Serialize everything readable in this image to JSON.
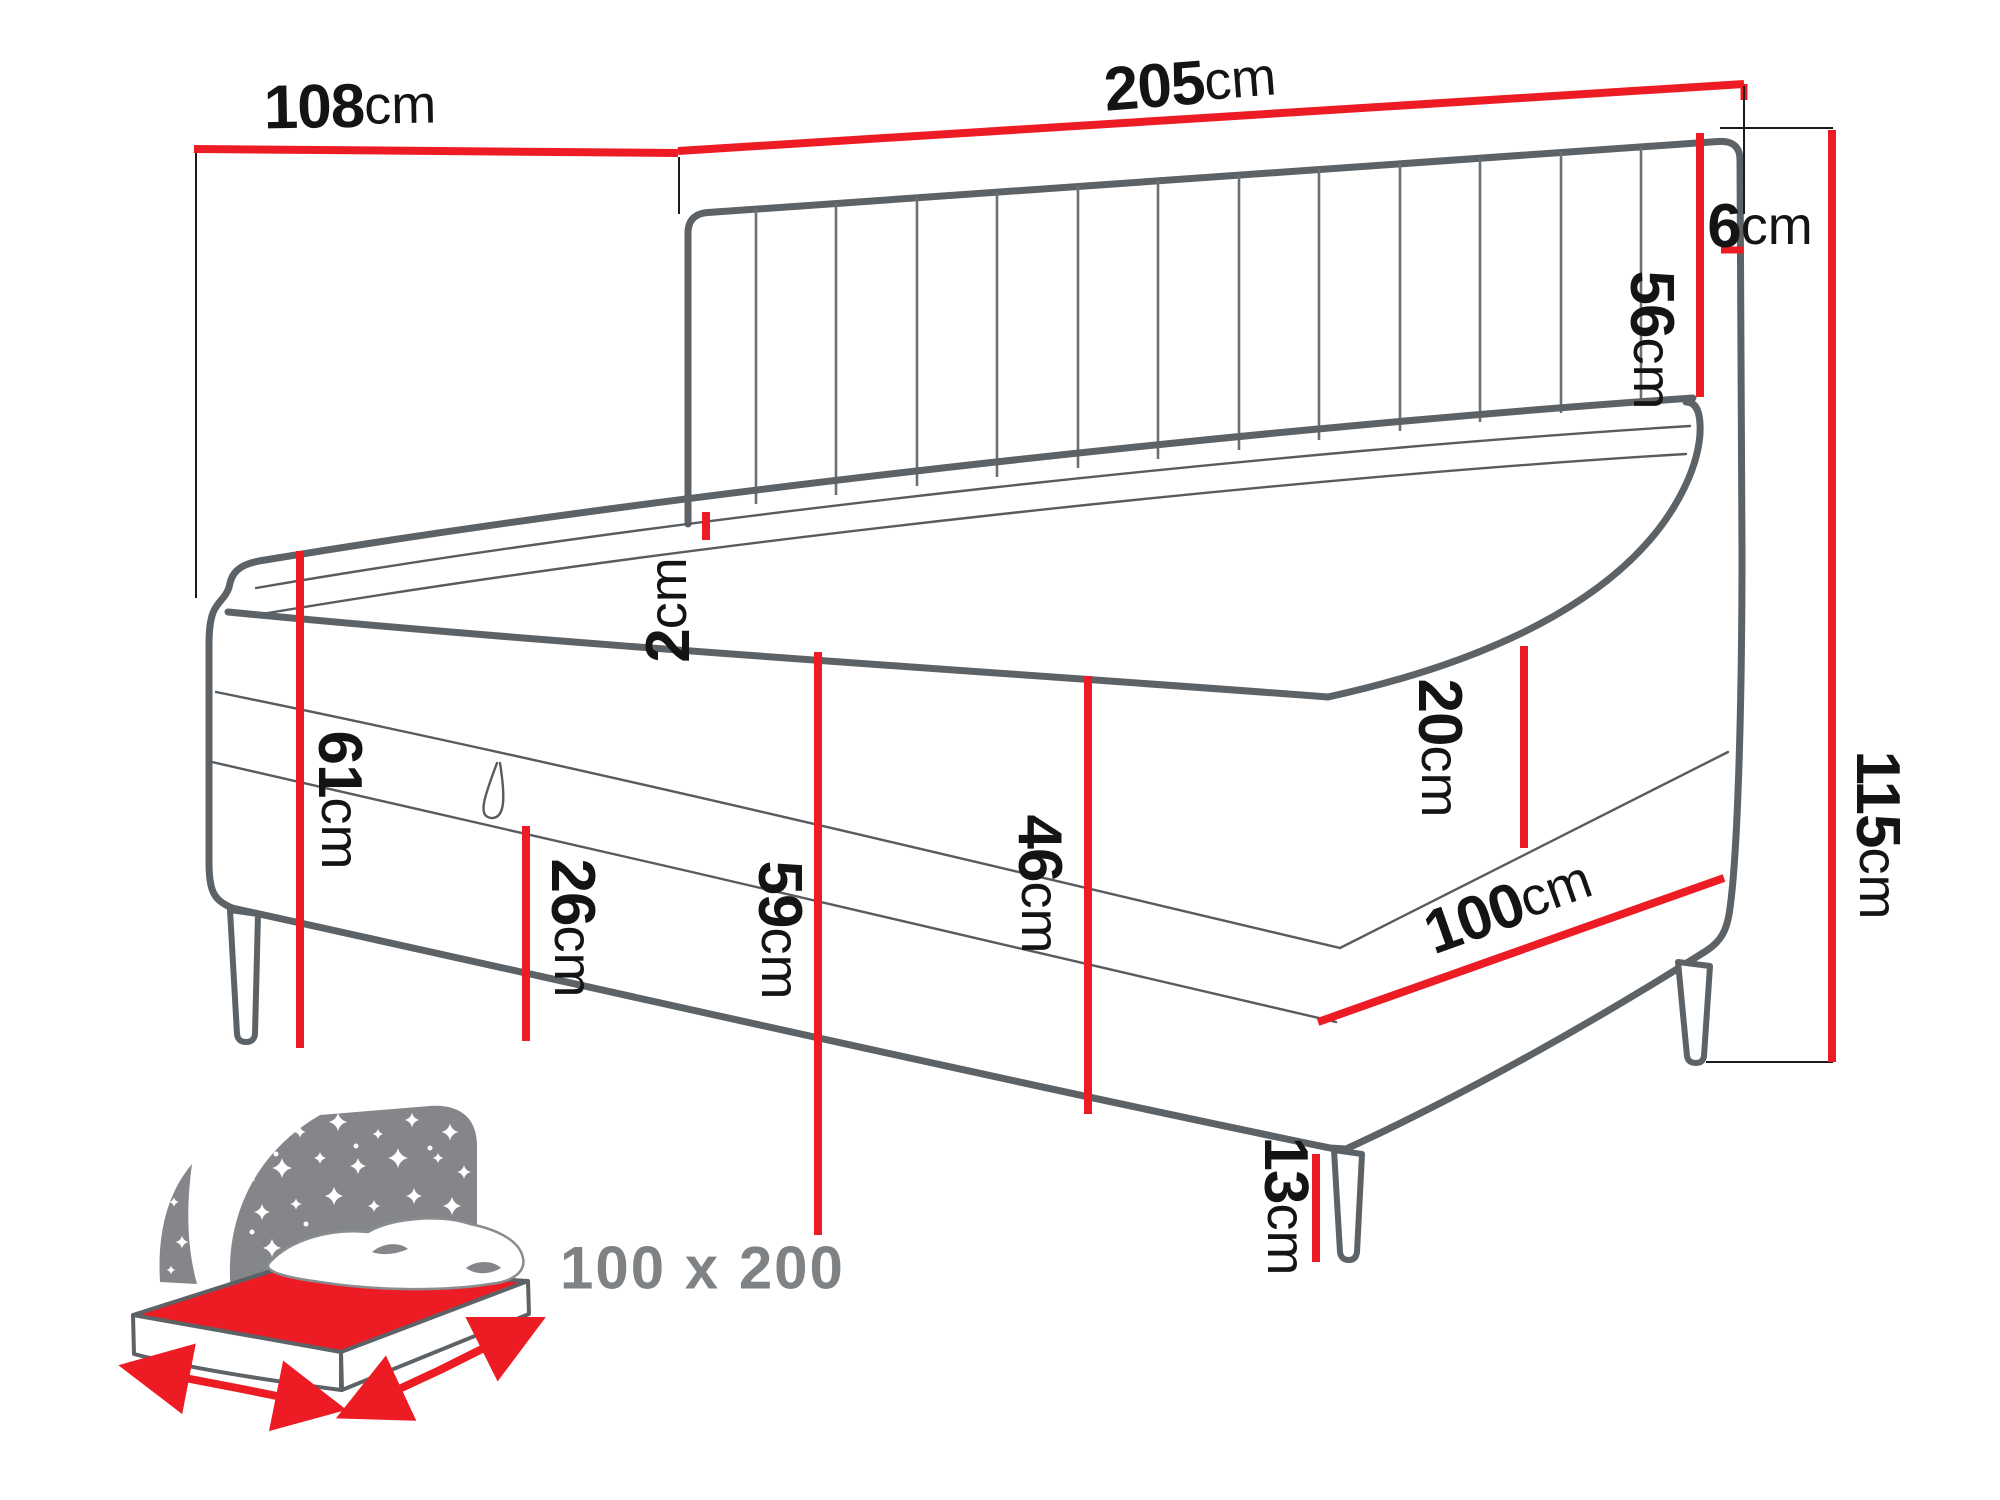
{
  "title": "Corner daybed dimensions diagram",
  "dimensions": {
    "side_panel_width": {
      "value": "108",
      "unit": "cm"
    },
    "total_length": {
      "value": "205",
      "unit": "cm"
    },
    "headboard_top_gap": {
      "value": "6",
      "unit": "cm"
    },
    "headboard_height": {
      "value": "56",
      "unit": "cm"
    },
    "total_height": {
      "value": "115",
      "unit": "cm"
    },
    "topper_thickness": {
      "value": "2",
      "unit": "cm"
    },
    "seat_height": {
      "value": "61",
      "unit": "cm"
    },
    "storage_height": {
      "value": "26",
      "unit": "cm"
    },
    "base_height": {
      "value": "59",
      "unit": "cm"
    },
    "frame_height": {
      "value": "46",
      "unit": "cm"
    },
    "mattress_height": {
      "value": "20",
      "unit": "cm"
    },
    "bed_width": {
      "value": "100",
      "unit": "cm"
    },
    "leg_height": {
      "value": "13",
      "unit": "cm"
    }
  },
  "badge": {
    "mattress_size": "100 x 200"
  },
  "icons": {
    "sleep_bed_icon": "starry-headboard-bed-icon"
  },
  "colors": {
    "dimension_red": "#ed1c24",
    "outline_gray": "#5c6266",
    "icon_gray": "#848689",
    "badge_gray": "#7f8285",
    "label_black": "#141414"
  }
}
